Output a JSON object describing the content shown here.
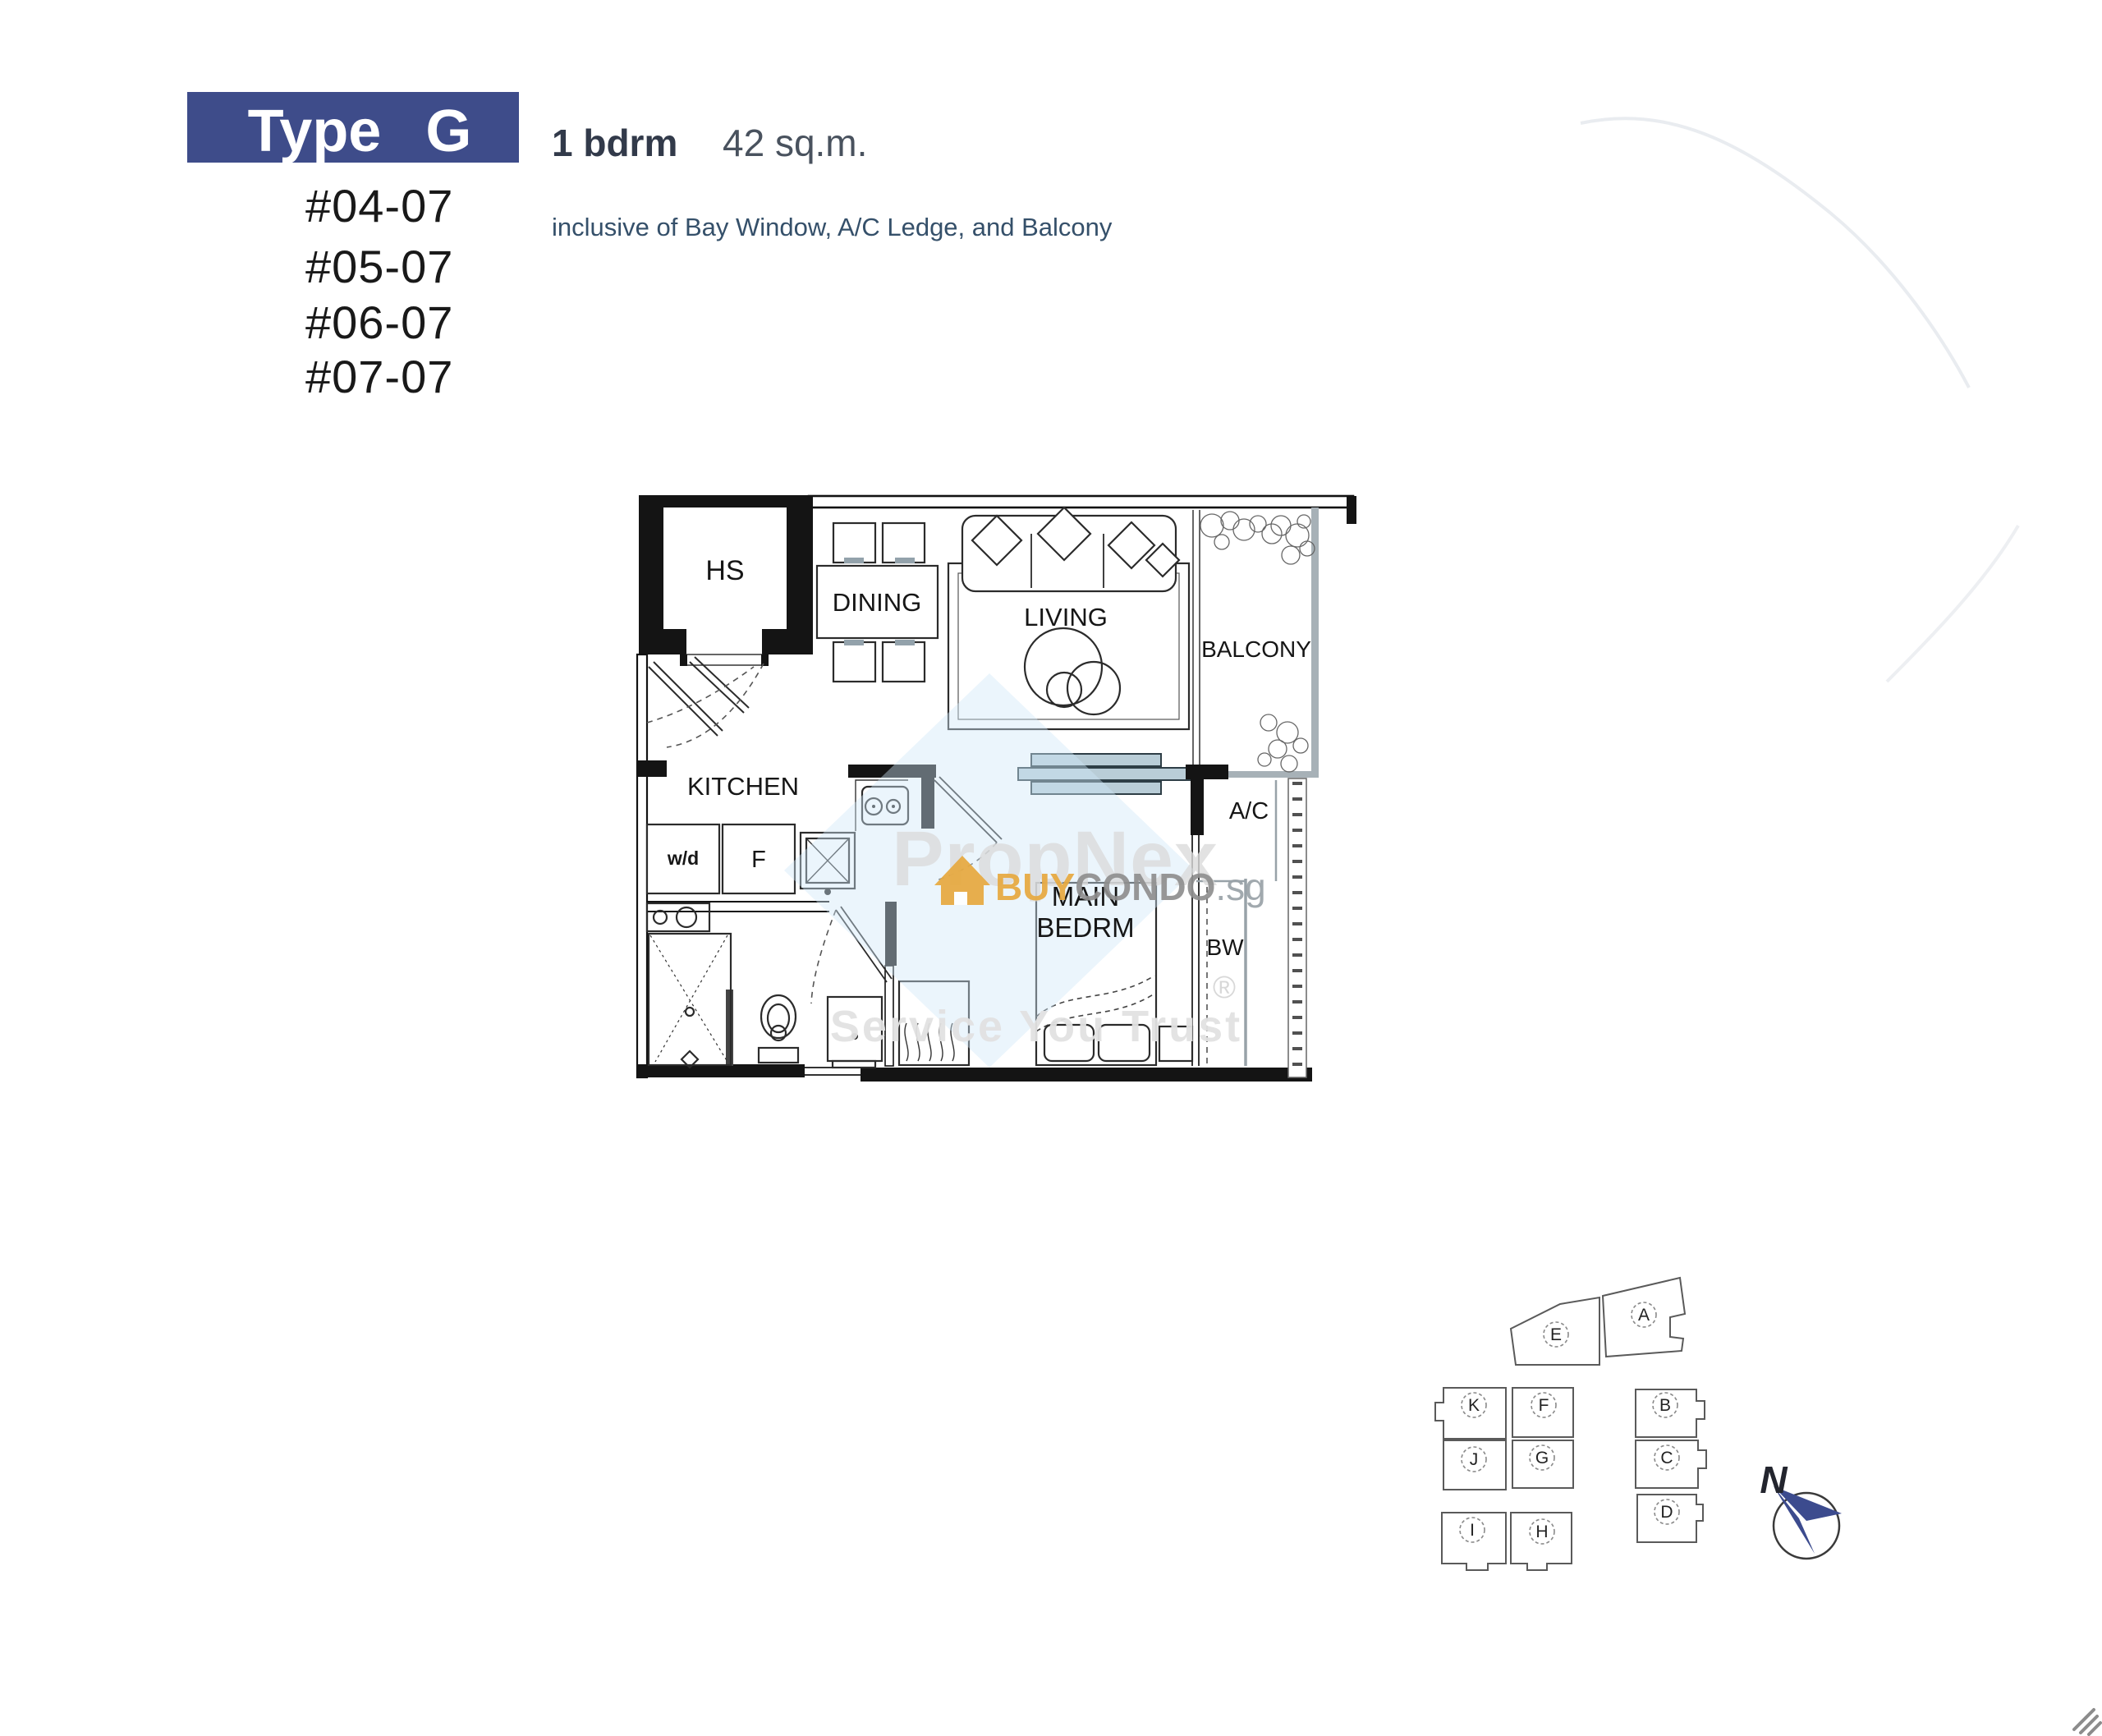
{
  "header": {
    "type_label": "Type G",
    "bedroom_label": "1 bdrm",
    "area_label": "42 sq.m.",
    "inclusive_note": "inclusive of Bay Window, A/C Ledge, and Balcony",
    "unit_numbers": [
      "#04-07",
      "#05-07",
      "#06-07",
      "#07-07"
    ]
  },
  "floorplan": {
    "labels": {
      "hs": "HS",
      "dining": "DINING",
      "living": "LIVING",
      "balcony": "BALCONY",
      "kitchen": "KITCHEN",
      "washer_dryer": "w/d",
      "fridge": "F",
      "main_bedroom_line1": "MAIN",
      "main_bedroom_line2": "BEDRM",
      "ac_ledge": "A/C",
      "bay_window": "BW"
    }
  },
  "watermark": {
    "brand": "PropNex",
    "buy": "BUY",
    "condo": "CONDO",
    "suffix": ".sg",
    "registered": "®",
    "tagline": "Service You Trust"
  },
  "site_map": {
    "units": [
      "E",
      "A",
      "K",
      "F",
      "B",
      "J",
      "G",
      "C",
      "I",
      "H",
      "D"
    ],
    "highlighted_unit": "G",
    "north_label": "N"
  },
  "colors": {
    "banner_bg": "#3E4C8A",
    "accent_orange": "#E7A93F",
    "watermark_blue": "#CFE8F8",
    "watermark_gray": "#DCDCDC",
    "highlight_gray": "#D9D9D9",
    "compass_navy": "#3C4B8E"
  }
}
